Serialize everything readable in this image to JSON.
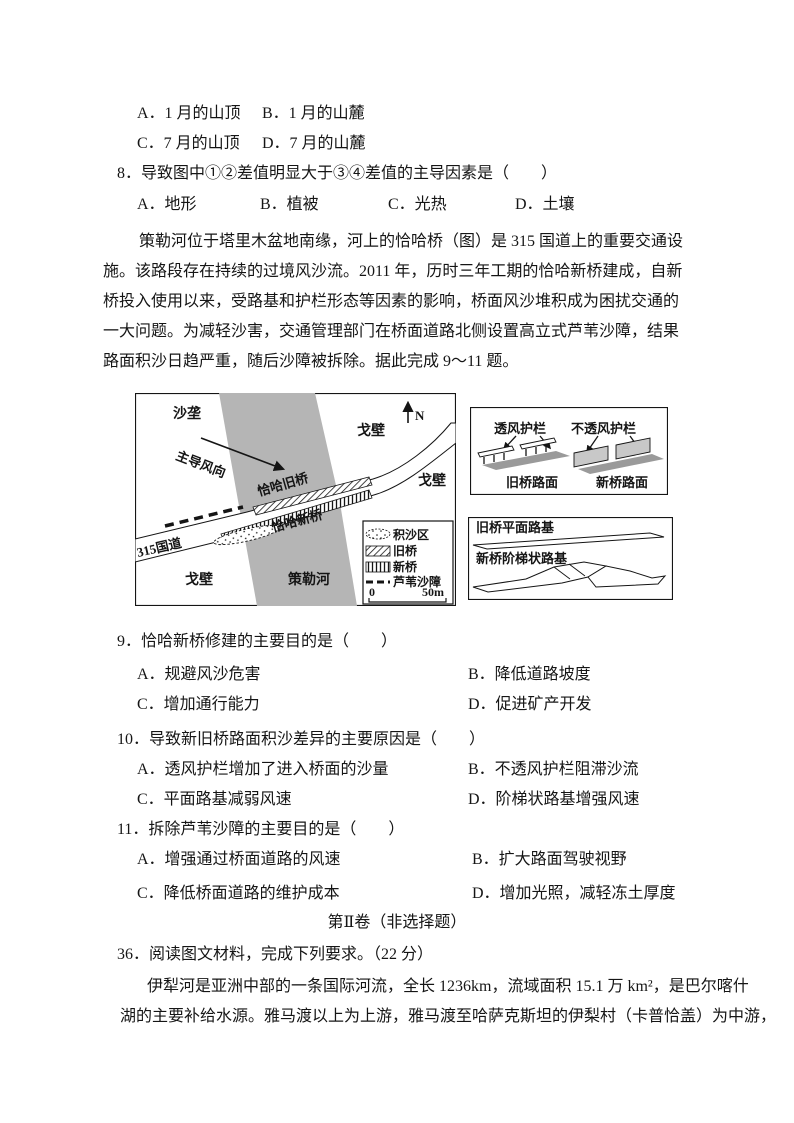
{
  "q7_options": {
    "a": "A．1 月的山顶",
    "b": "B．1 月的山麓",
    "c": "C．7 月的山顶",
    "d": "D．7 月的山麓"
  },
  "q8": {
    "stem": "8．导致图中①②差值明显大于③④差值的主导因素是（　　）",
    "a": "A．地形",
    "b": "B．植被",
    "c": "C．光热",
    "d": "D．土壤"
  },
  "passage1": {
    "lines": [
      "策勒河位于塔里木盆地南缘，河上的恰哈桥（图）是 315 国道上的重要交通设",
      "施。该路段存在持续的过境风沙流。2011 年，历时三年工期的恰哈新桥建成，自新",
      "桥投入使用以来，受路基和护栏形态等因素的影响，桥面风沙堆积成为困扰交通的",
      "一大问题。为减轻沙害，交通管理部门在桥面道路北侧设置高立式芦苇沙障，结果",
      "路面积沙日趋严重，随后沙障被拆除。据此完成 9～11 题。"
    ]
  },
  "figure": {
    "map": {
      "labels": {
        "sand_ridge": "沙垄",
        "wind_direction": "主导风向",
        "gobi_top": "戈壁",
        "gobi_right": "戈壁",
        "gobi_bottom": "戈壁",
        "river": "策勒河",
        "old_bridge": "恰哈旧桥",
        "new_bridge": "恰哈新桥",
        "road": "315国道",
        "north": "N"
      },
      "legend": {
        "sand_area": "积沙区",
        "old_bridge": "旧桥",
        "new_bridge": "新桥",
        "reed_barrier": "芦苇沙障",
        "scale_start": "0",
        "scale_end": "50m"
      }
    },
    "railing_panel": {
      "permeable": "透风护栏",
      "impermeable": "不透风护栏",
      "old_surface": "旧桥路面",
      "new_surface": "新桥路面"
    },
    "roadbed_panel": {
      "old": "旧桥平面路基",
      "new": "新桥阶梯状路基"
    },
    "colors": {
      "river_gray": "#b5b5b5",
      "surface_gray": "#9a9a9a",
      "plate_gray": "#c8c8c8"
    }
  },
  "q9": {
    "stem": "9．恰哈新桥修建的主要目的是（　　）",
    "a": "A．规避风沙危害",
    "b": "B．降低道路坡度",
    "c": "C．增加通行能力",
    "d": "D．促进矿产开发"
  },
  "q10": {
    "stem": "10．导致新旧桥路面积沙差异的主要原因是（　　）",
    "a": "A．透风护栏增加了进入桥面的沙量",
    "b": "B．不透风护栏阻滞沙流",
    "c": "C．平面路基减弱风速",
    "d": "D．阶梯状路基增强风速"
  },
  "q11": {
    "stem": "11．拆除芦苇沙障的主要目的是（　　）",
    "a": "A．增强通过桥面道路的风速",
    "b": "B．扩大路面驾驶视野",
    "c": "C．降低桥面道路的维护成本",
    "d": "D．增加光照，减轻冻土厚度"
  },
  "section2_title": "第Ⅱ卷（非选择题）",
  "q36": {
    "stem": "36．阅读图文材料，完成下列要求。（22 分）",
    "lines": [
      "伊犁河是亚洲中部的一条国际河流，全长 1236km，流域面积 15.1 万 km²，是巴尔喀什",
      "湖的主要补给水源。雅马渡以上为上游，雅马渡至哈萨克斯坦的伊梨村（卡普恰盖）为中游，"
    ]
  }
}
